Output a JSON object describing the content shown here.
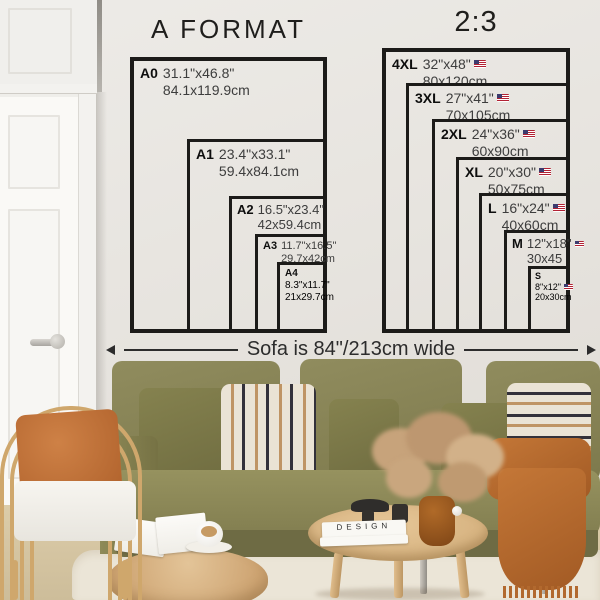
{
  "titles": {
    "left": "A FORMAT",
    "right": "2:3"
  },
  "a_format": {
    "boxes": [
      {
        "name": "A0",
        "inches": "31.1\"x46.8\"",
        "cm": "84.1x119.9cm"
      },
      {
        "name": "A1",
        "inches": "23.4\"x33.1\"",
        "cm": "59.4x84.1cm"
      },
      {
        "name": "A2",
        "inches": "16.5\"x23.4\"",
        "cm": "42x59.4cm"
      },
      {
        "name": "A3",
        "inches": "11.7\"x16.5\"",
        "cm": "29.7x42cm"
      },
      {
        "name": "A4",
        "inches": "8.3\"x11.7\"",
        "cm": "21x29.7cm"
      }
    ]
  },
  "ratio": {
    "flag_icon": "us-flag-icon",
    "boxes": [
      {
        "name": "4XL",
        "inches": "32\"x48\"",
        "cm": "80x120cm"
      },
      {
        "name": "3XL",
        "inches": "27\"x41\"",
        "cm": "70x105cm"
      },
      {
        "name": "2XL",
        "inches": "24\"x36\"",
        "cm": "60x90cm"
      },
      {
        "name": "XL",
        "inches": "20\"x30\"",
        "cm": "50x75cm"
      },
      {
        "name": "L",
        "inches": "16\"x24\"",
        "cm": "40x60cm"
      },
      {
        "name": "M",
        "inches": "12\"x18\"",
        "cm": "30x45"
      },
      {
        "name": "S",
        "inches": "8\"x12\"",
        "cm": "20x30cm"
      }
    ]
  },
  "sofa_label": "Sofa is 84\"/213cm wide",
  "book_title": "DESIGN",
  "palette": {
    "wall": "#e7e4df",
    "line": "#1c1b19",
    "text_dim": "#3d3d3d",
    "sofa": "#868252",
    "pillow_cream": "#eae3d5",
    "stripe_dark": "#33313a",
    "stripe_tan": "#bf9464",
    "rust": "#bd6f33",
    "rattan": "#cfa76c",
    "wood": "#dcbb8a",
    "flag_red": "#b22234",
    "flag_blue": "#3c3b6e"
  }
}
